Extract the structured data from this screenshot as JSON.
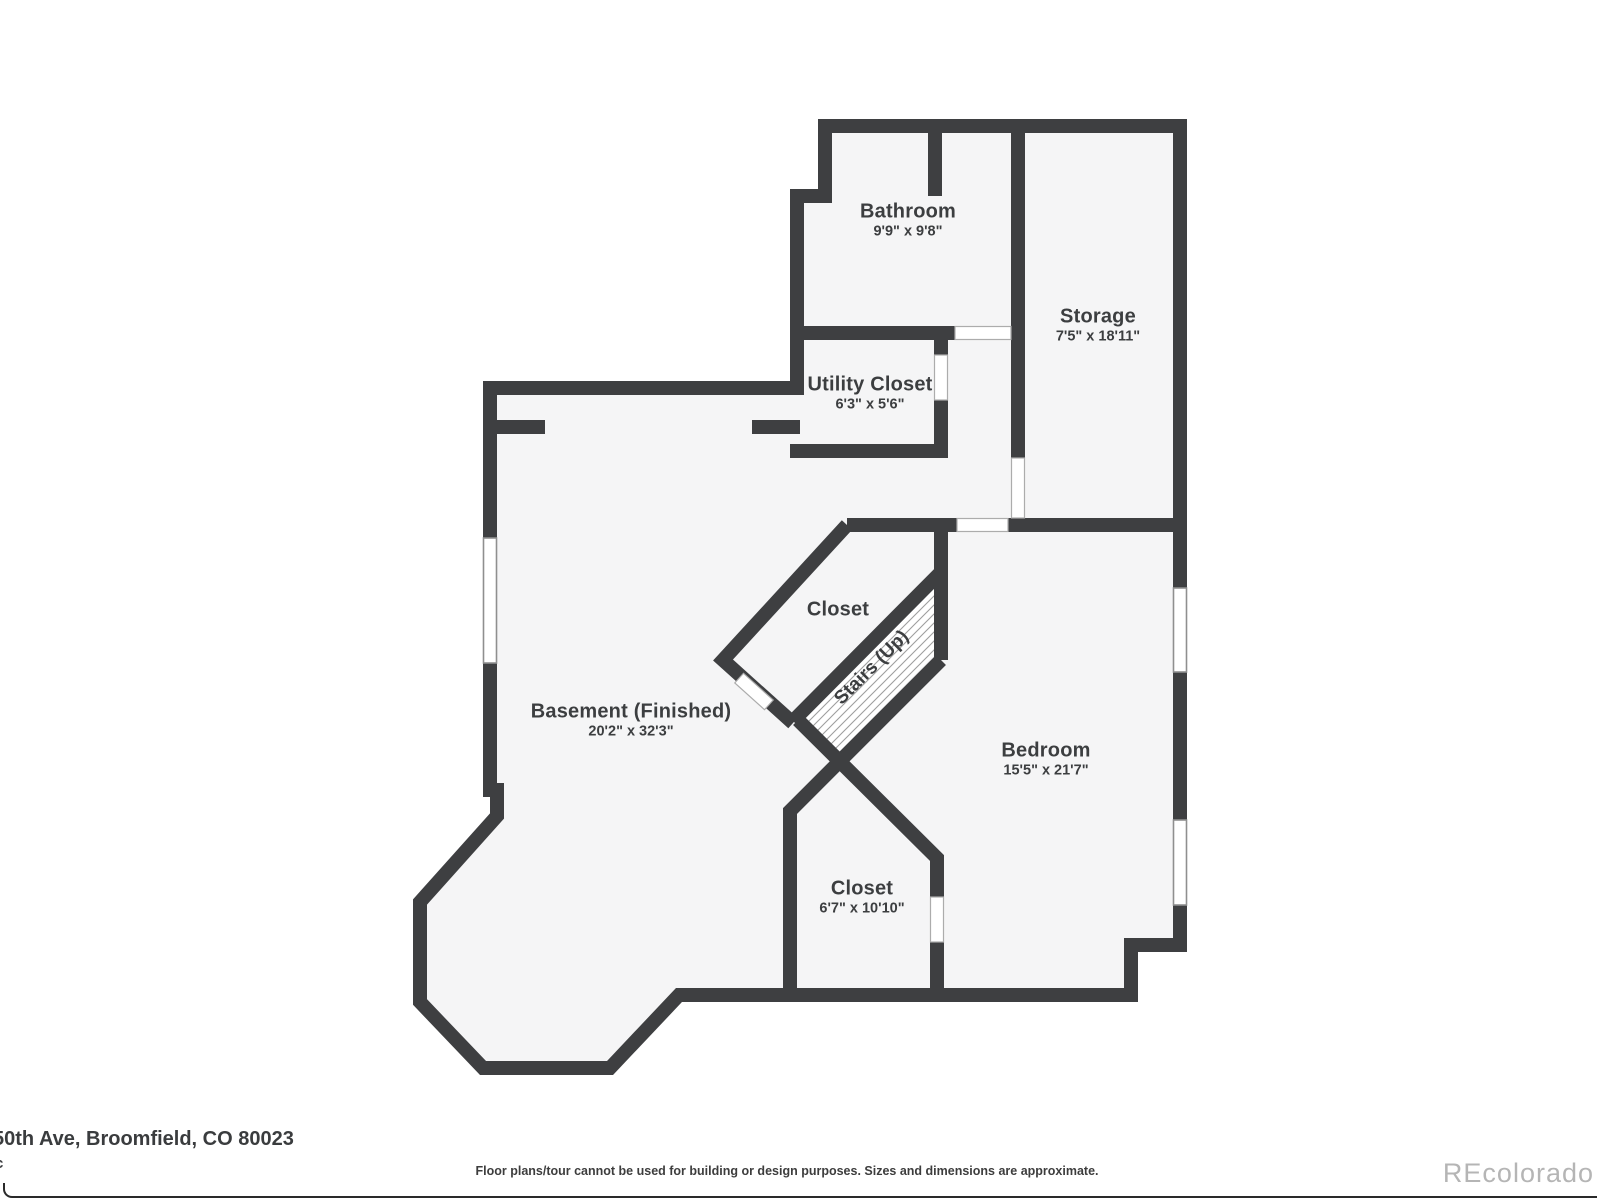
{
  "rooms": {
    "bathroom": {
      "name": "Bathroom",
      "dims": "9'9\" x 9'8\""
    },
    "storage": {
      "name": "Storage",
      "dims": "7'5\" x 18'11\""
    },
    "utility_closet": {
      "name": "Utility Closet",
      "dims": "6'3\" x 5'6\""
    },
    "closet_upper": {
      "name": "Closet"
    },
    "stairs": {
      "name": "Stairs (Up)"
    },
    "basement": {
      "name": "Basement (Finished)",
      "dims": "20'2\" x 32'3\""
    },
    "bedroom": {
      "name": "Bedroom",
      "dims": "15'5\" x 21'7\""
    },
    "closet_lower": {
      "name": "Closet",
      "dims": "6'7\" x 10'10\""
    }
  },
  "footer": {
    "address_partial": "50th Ave, Broomfield, CO 80023",
    "address_partial_line2": "c",
    "disclaimer": "Floor plans/tour cannot be used for building or design purposes. Sizes and dimensions are approximate.",
    "watermark": "REcolorado"
  },
  "colors": {
    "wall": "#3e3f41",
    "floor": "#f5f5f6",
    "label_text": "#3c3e40",
    "watermark_gray": "#b5b5b5"
  }
}
